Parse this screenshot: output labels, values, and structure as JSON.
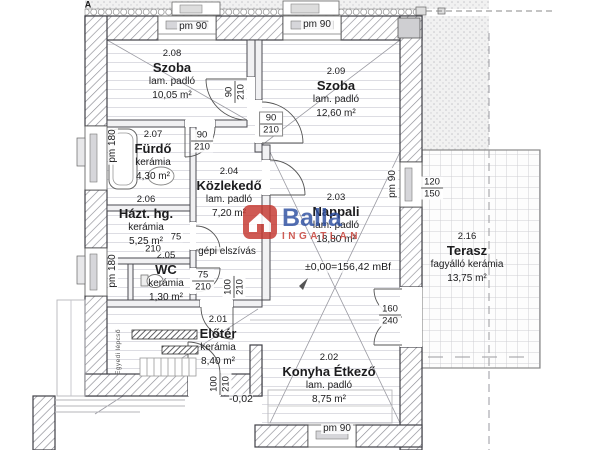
{
  "brand": {
    "name": "Balla",
    "sub": "INGATLAN",
    "logo_color": "#c5372f",
    "brand_color": "#2d4fa1"
  },
  "rooms": [
    {
      "id": "2.08",
      "name": "Szoba",
      "floor": "lam. padló",
      "area": "10,05 m²"
    },
    {
      "id": "2.09",
      "name": "Szoba",
      "floor": "lam. padló",
      "area": "12,60 m²"
    },
    {
      "id": "2.07",
      "name": "Fürdő",
      "floor": "kerámia",
      "area": "4,30 m²"
    },
    {
      "id": "2.06",
      "name": "Házt. hg.",
      "floor": "kerámia",
      "area": "5,25 m²"
    },
    {
      "id": "2.05",
      "name": "WC",
      "floor": "kerámia",
      "area": "1,30 m²"
    },
    {
      "id": "2.04",
      "name": "Közlekedő",
      "floor": "lam. padló",
      "area": "7,20 m²"
    },
    {
      "id": "2.03",
      "name": "Nappali",
      "floor": "lam. padló",
      "area": "18,80 m²"
    },
    {
      "id": "2.01",
      "name": "Előtér",
      "floor": "kerámia",
      "area": "8,40 m²"
    },
    {
      "id": "2.02",
      "name": "Konyha Étkező",
      "floor": "lam. padló",
      "area": "8,75 m²"
    },
    {
      "id": "2.16",
      "name": "Terasz",
      "floor": "fagyálló kerámia",
      "area": "13,75 m²"
    }
  ],
  "annotations": {
    "pm90": "pm 90",
    "pm180": "pm 180",
    "level_living": "±0,00=156,42 mBf",
    "level_entry": "-0,02",
    "exhaust": "gépi elszívás",
    "stair_note": "Egyedi lépcső",
    "section": "A"
  },
  "dims": {
    "d90": "90",
    "d210": "210",
    "d75": "75",
    "d100": "100",
    "d120": "120",
    "d150": "150",
    "d160": "160",
    "d240": "240"
  }
}
